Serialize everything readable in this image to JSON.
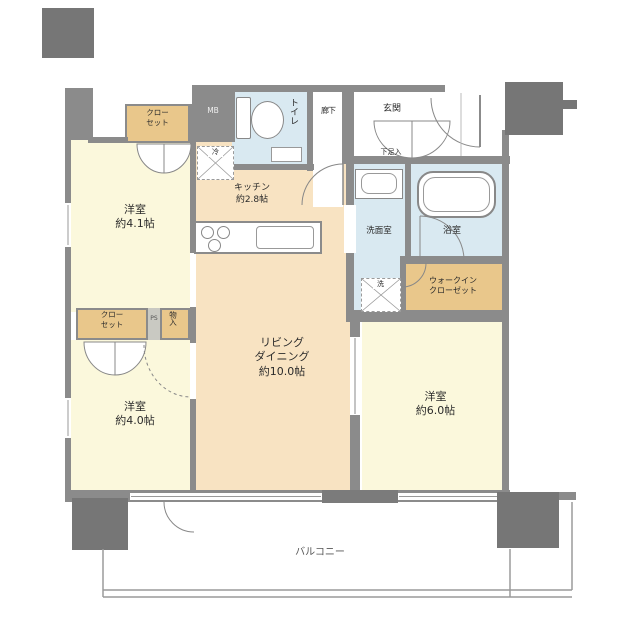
{
  "plan_title": "apartment-floor-plan",
  "rooms": {
    "living_dining": {
      "line1": "リビング",
      "line2": "ダイニング",
      "size": "約10.0帖"
    },
    "kitchen": {
      "name": "キッチン",
      "size": "約2.8帖"
    },
    "bedroom_top_left": {
      "name": "洋室",
      "size": "約4.1帖"
    },
    "bedroom_bottom_left": {
      "name": "洋室",
      "size": "約4.0帖"
    },
    "bedroom_right": {
      "name": "洋室",
      "size": "約6.0帖"
    },
    "toilet": {
      "name": "トイレ"
    },
    "washroom": {
      "name": "洗面室"
    },
    "bath": {
      "name": "浴室"
    },
    "hallway": {
      "name": "廊下"
    },
    "entrance": {
      "name": "玄関"
    },
    "shoe_cabinet": {
      "name": "下足入"
    },
    "walk_in_closet": {
      "line1": "ウォークイン",
      "line2": "クローゼット"
    },
    "closet_top": {
      "line1": "クロー",
      "line2": "セット"
    },
    "closet_middle": {
      "line1": "クロー",
      "line2": "セット"
    },
    "storage": {
      "name": "物入"
    },
    "balcony": {
      "name": "バルコニー"
    }
  },
  "labels": {
    "meter_box": "MB",
    "pipe_space": "PS",
    "fridge_space": "冷",
    "washer_space": "洗"
  },
  "colors": {
    "wall": "#8b8b8b",
    "pillar": "#767676",
    "bedroom_floor": "#fbf8dc",
    "living_floor": "#f8e3c2",
    "wet_area_floor": "#d9e9f1",
    "closet_floor": "#e9c78b",
    "background": "#ffffff"
  }
}
